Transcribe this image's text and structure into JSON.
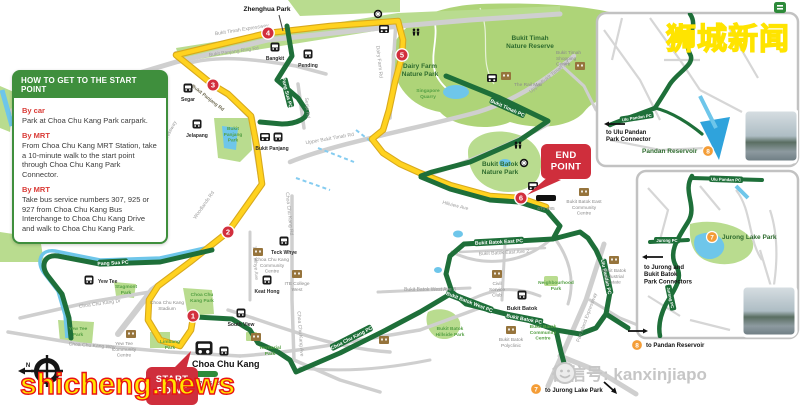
{
  "watermarks": {
    "site_cn": "狮城新闻",
    "site_en": "shicheng.news",
    "wechat": "微信号: kanxinjiapo"
  },
  "info_box": {
    "title": "HOW TO GET TO THE START POINT",
    "sections": [
      {
        "heading": "By car",
        "body": "Park at Choa Chu Kang Park carpark."
      },
      {
        "heading": "By MRT",
        "body": "From Choa Chu Kang MRT Station, take a 10-minute walk to the start point through Choa Chu Kang Park Connector."
      },
      {
        "heading": "By MRT",
        "body": "Take bus service numbers 307, 925 or 927 from Choa Chu Kang Bus Interchange to Choa Chu Kang Drive and walk to Choa Chu Kang Park."
      }
    ]
  },
  "callouts": {
    "start": "START\nPOINT",
    "end": "END\nPOINT"
  },
  "markers": {
    "m1": "1",
    "m2": "2",
    "m3": "3",
    "m4": "4",
    "m5": "5",
    "m6": "6",
    "m7": "7",
    "m8": "8"
  },
  "compass": {
    "north": "N"
  },
  "labels": {
    "zhenghua": "Zhenghua Park",
    "btnr": "Bukit Timah\nNature Reserve",
    "dairy_farm": "Dairy Farm\nNature Park",
    "quarry": "Singapore\nQuarry",
    "bp_park": "Bukit\nPanjang\nPark",
    "bbnp": "Bukit Batok\nNature Park",
    "hillside": "Bukit Batok\nHillside Park",
    "cck_park": "Choa Chu\nKang Park",
    "yewtee_park": "Yew Tee\nPark",
    "stagmont": "Stagmont\nPark",
    "limbang": "Limbang\nPark",
    "territorial": "Territorial\nPark",
    "neighbourhood": "Neighbourhood\nPark",
    "jurong_lake_park": "Jurong Lake Park",
    "pandan_reservoir": "Pandan Reservoir",
    "rail_mall": "The Rail Mall",
    "bt_shopping": "Bukit Timah\nShopping\nCentre",
    "bbe_cc": "Bukit Batok East\nCommunity\nCentre",
    "bb_industrial": "Bukit Batok\nIndustrial\nEstate",
    "civil_service": "Civil\nService\nClub",
    "bb_polyclinic": "Bukit Batok\nPolyclinic",
    "bb_cc": "Bukit Batok\nCommunity\nCentre",
    "cck_cc": "Choa Chu Kang\nCommunity\nCentre",
    "ite_west": "ITE College\nWest",
    "yt_cc": "Yew Tee\nCommunity\nCentre",
    "cck_stadium": "Choa Chu Kang\nStadium",
    "st_yew_tee": "Yew Tee",
    "st_bukit_panjang": "Bukit Panjang",
    "st_teck_whye": "Teck Whye",
    "st_keat_hong": "Keat Hong",
    "st_south_view": "South View",
    "st_segar": "Segar",
    "st_jelapang": "Jelapang",
    "st_bangkit": "Bangkit",
    "st_pending": "Pending",
    "st_bukit_batok": "Bukit Batok",
    "st_cck": "Choa Chu Kang",
    "bus_cck": "307 925 927",
    "bus_hillview": "670 985",
    "rd_bke": "Bukit Timah Expressway",
    "rd_kje": "Kranji Expressway",
    "rd_woodlands": "Woodlands Rd",
    "rd_bp_ring": "Bukit Panjang Ring Rd",
    "rd_bp": "Bukit Panjang Rd",
    "rd_senja": "Senja Rd",
    "rd_dairy": "Dairy Farm Rd",
    "rd_ubt": "Upper Bukit Timah Rd",
    "rd_hillview": "Hillview Ave",
    "rd_cck": "Choa Chu Kang Rd",
    "rd_cck_dr": "Choa Chu Kang Dr",
    "rd_cck_way": "Choa Chu Kang Way",
    "rd_cck_ave": "Choa Chu Kang Ave",
    "rd_tw_ave": "Teck Whye Ave",
    "rd_bbw3": "Bukit Batok West Ave 3",
    "rd_bbe2": "Bukit Batok East Ave 2",
    "rd_pie": "Pan Island Expressway",
    "rt_pang_sua": "Pang Sua PC",
    "rt_bt": "Bukit Timah PC",
    "rt_bbe": "Bukit Batok East PC",
    "rt_bb": "Bukit Batok PC",
    "rt_bbw": "Bukit Batok West PC",
    "rt_up": "Ulu Pandan PC",
    "rt_cck": "Choa Chu Kang PC",
    "rt_jurong": "Jurong PC",
    "to_ulu": "to Ulu Pandan\nPark Connector",
    "to_jurong_bb": "to Jurong and\nBukit Batok\nPark Connectors",
    "to_pandan": "to Pandan Reservoir",
    "to_jlp": "to Jurong Lake Park"
  }
}
